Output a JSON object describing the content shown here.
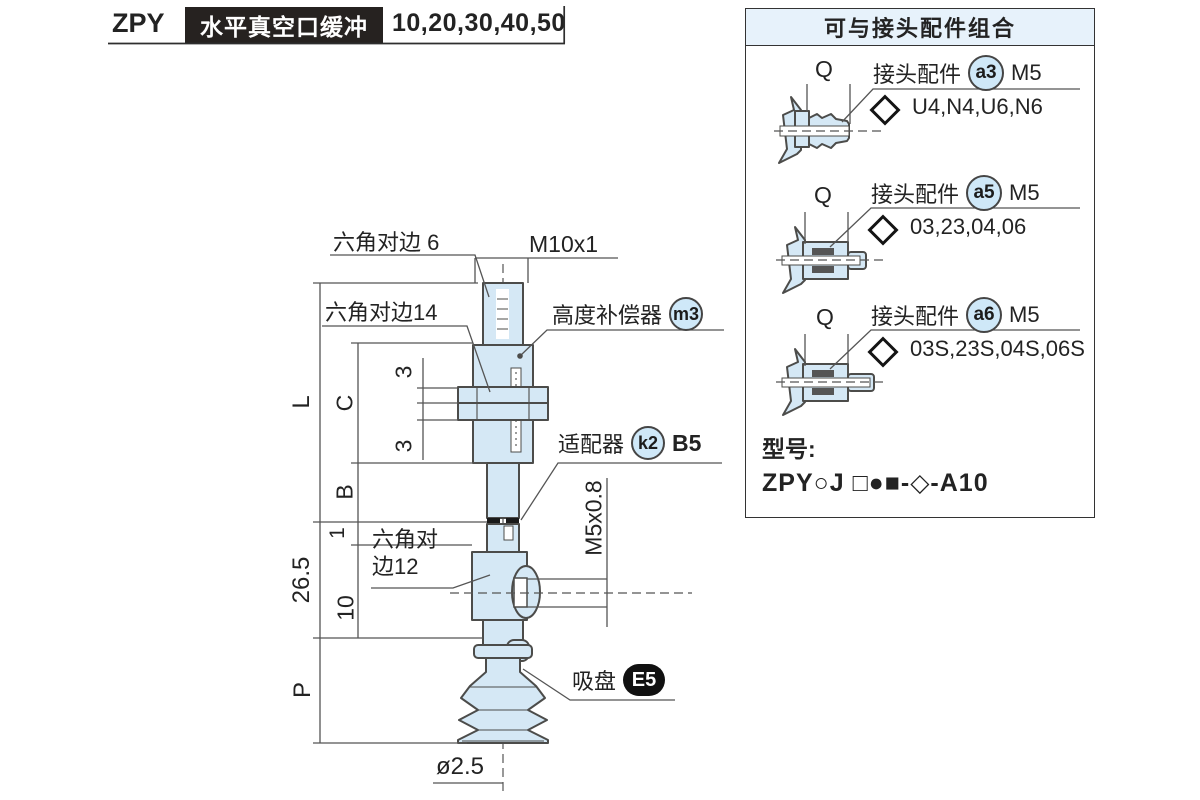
{
  "header": {
    "code": "ZPY",
    "title": "水平真空口缓冲",
    "sizes": "10,20,30,40,50"
  },
  "panel": {
    "title": "可与接头配件组合",
    "q": "Q",
    "rows": [
      {
        "label": "接头配件",
        "badge": "a3",
        "thread": "M5",
        "codes": "U4,N4,U6,N6"
      },
      {
        "label": "接头配件",
        "badge": "a5",
        "thread": "M5",
        "codes": "03,23,04,06"
      },
      {
        "label": "接头配件",
        "badge": "a6",
        "thread": "M5",
        "codes": "03S,23S,04S,06S"
      }
    ],
    "model_label": "型号:",
    "model": "ZPY○J □●■-◇-A10"
  },
  "drawing": {
    "hex6": "六角对边 6",
    "m10": "M10x1",
    "hex14": "六角对边14",
    "compensator": "高度补偿器",
    "compensator_badge": "m3",
    "adapter": "适配器",
    "adapter_badge": "k2",
    "adapter_code": "B5",
    "m5": "M5x0.8",
    "hex12_line1": "六角对",
    "hex12_line2": "边12",
    "cup": "吸盘",
    "cup_badge": "E5",
    "dia": "ø2.5",
    "dims": {
      "L": "L",
      "C": "C",
      "B": "B",
      "t1": "3",
      "t2": "3",
      "one": "1",
      "v265": "26.5",
      "ten": "10",
      "P": "P"
    }
  },
  "colors": {
    "part_fill": "#d5e8f5",
    "line": "#4c4c4a",
    "panel_header_bg": "#e7f2fb",
    "badge_bg": "#cfe8f8"
  }
}
